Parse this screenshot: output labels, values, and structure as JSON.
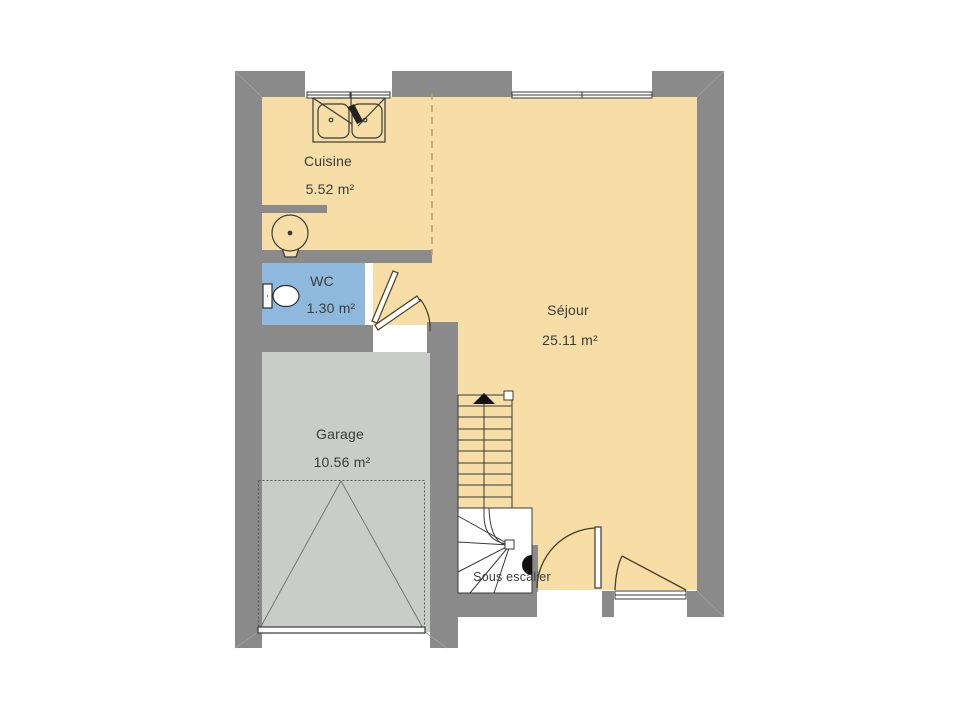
{
  "plan": {
    "type": "floor-plan",
    "language": "fr",
    "colors": {
      "background": "#FFFFFF",
      "wall": "#8A8A8A",
      "line": "#3A3A3A",
      "text": "#3B3B3B",
      "floor_main": "#F6DEA6",
      "floor_garage": "#C8CDC7",
      "floor_wc": "#8FB9DC",
      "floor_understair": "#FFFFFF",
      "room_divider_dash": "#BFA364"
    },
    "rooms": [
      {
        "name": "Cuisine",
        "area": "5.52 m²",
        "floor_color": "#F6DEA6"
      },
      {
        "name": "WC",
        "area": "1.30 m²",
        "floor_color": "#8FB9DC"
      },
      {
        "name": "Séjour",
        "area": "25.11 m²",
        "floor_color": "#F6DEA6"
      },
      {
        "name": "Garage",
        "area": "10.56 m²",
        "floor_color": "#C8CDC7"
      },
      {
        "name": "Sous escalier",
        "area": "",
        "floor_color": "#FFFFFF"
      }
    ],
    "fixtures": [
      "double-sink",
      "water-heater",
      "toilet",
      "staircase-with-up-arrow",
      "under-stair-winder",
      "garage-up-and-over-door",
      "entry-door-swing",
      "wc-door-swing",
      "kitchen-window",
      "sejour-window",
      "rear-casement-window"
    ]
  }
}
